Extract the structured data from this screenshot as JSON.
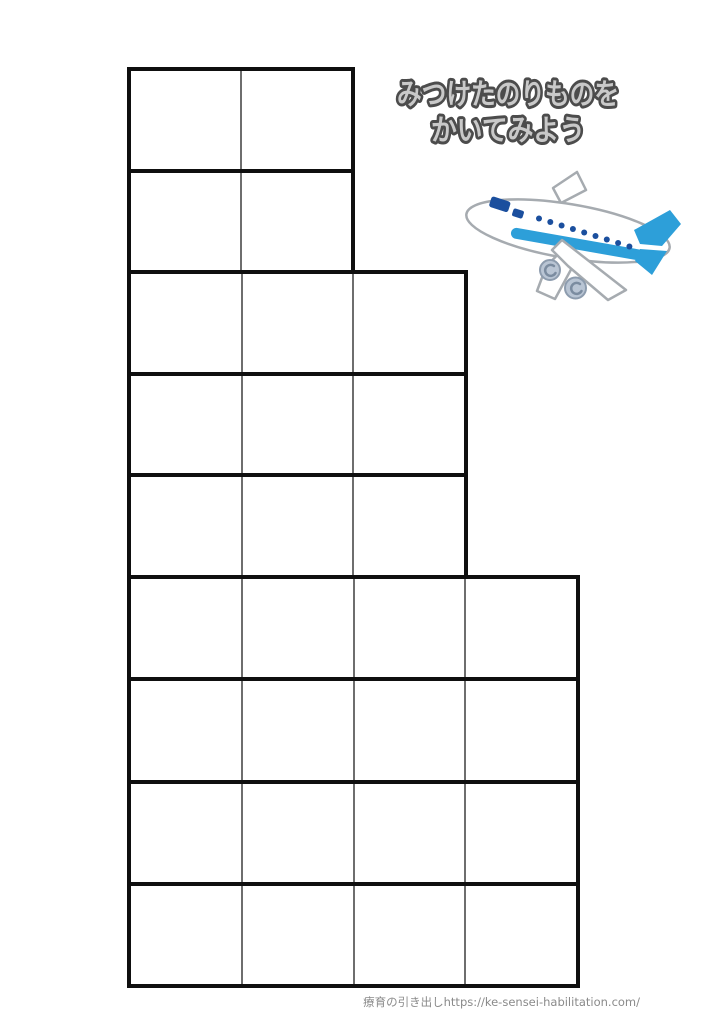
{
  "header": {
    "title_line1": "みつけたのりものを",
    "title_line2": "かいてみよう"
  },
  "worksheet": {
    "description": "blank-writing-grid",
    "sections": [
      {
        "name": "top-section",
        "rows": 2,
        "cols": 2
      },
      {
        "name": "middle-section",
        "rows": 3,
        "cols": 3
      },
      {
        "name": "bottom-section",
        "rows": 4,
        "cols": 4
      }
    ]
  },
  "illustration": {
    "name": "airplane",
    "accent_blue": "#2d9fd9",
    "navy": "#1b4f9e",
    "outline_gray": "#a6abb0",
    "engine_fill": "#b9c5d4",
    "engine_stroke": "#8d9cae"
  },
  "colors": {
    "grid_thick_line": "#0f0f0f",
    "grid_thin_line": "#6e6e6e",
    "title_fill": "#c9c9c9",
    "title_outline": "#4c4c4c",
    "footer_text": "#8a8a8a",
    "page_background": "#ffffff"
  },
  "footer": {
    "credit": "療育の引き出しhttps://ke-sensei-habilitation.com/"
  }
}
